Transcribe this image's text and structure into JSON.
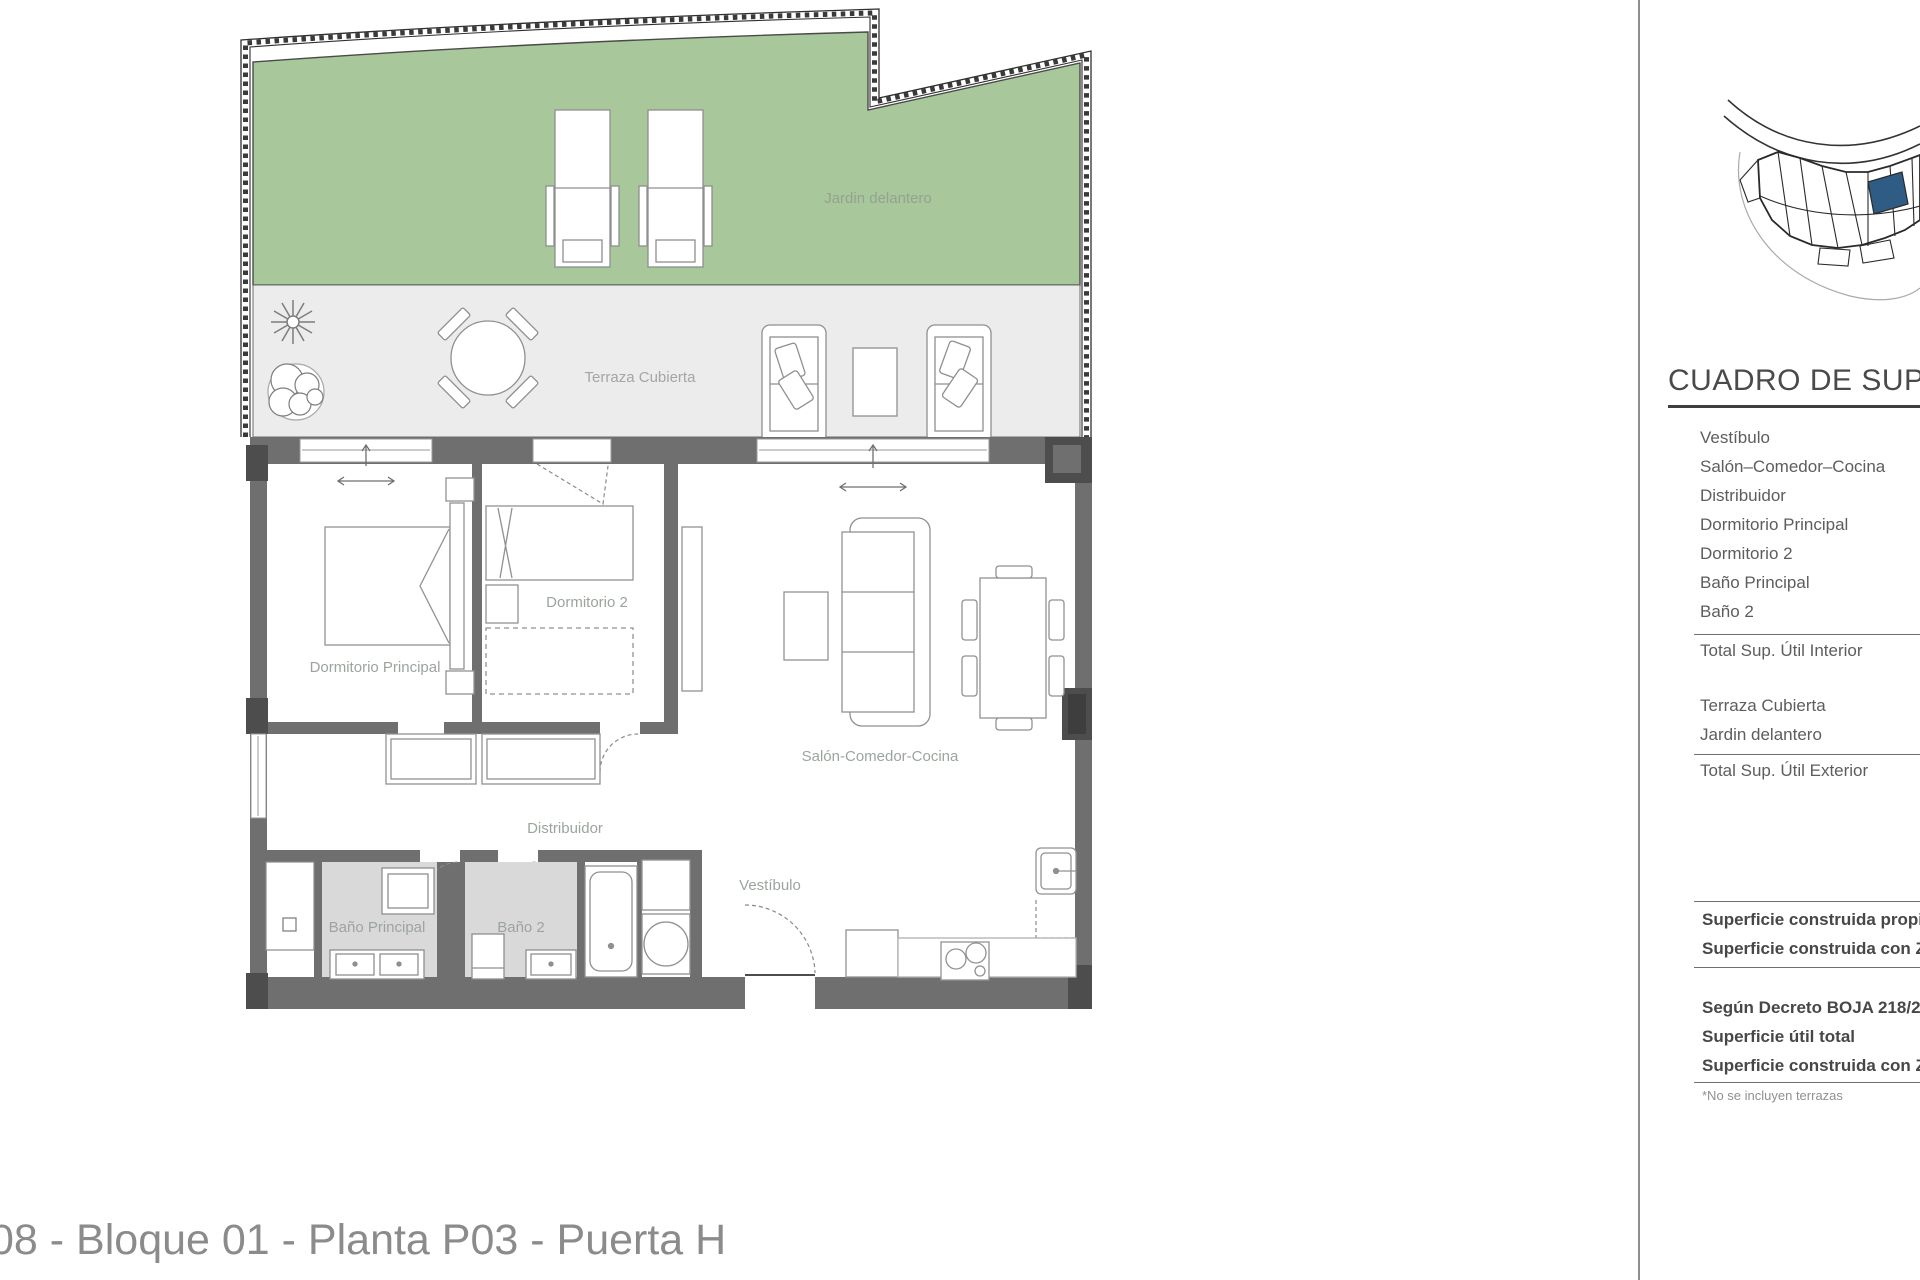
{
  "page": {
    "bottom_title": "08 - Bloque 01 - Planta P03 - Puerta H"
  },
  "plan": {
    "labels": {
      "garden": "Jardin delantero",
      "terrace": "Terraza Cubierta",
      "bedroom_main": "Dormitorio Principal",
      "bedroom_2": "Dormitorio 2",
      "living": "Salón-Comedor-Cocina",
      "hall": "Distribuidor",
      "vestibule": "Vestíbulo",
      "bath_main": "Baño Principal",
      "bath_2": "Baño 2"
    }
  },
  "panel": {
    "heading": "CUADRO DE SUPERF",
    "interior_rooms": [
      "Vestíbulo",
      "Salón–Comedor–Cocina",
      "Distribuidor",
      "Dormitorio Principal",
      "Dormitorio 2",
      "Baño Principal",
      "Baño 2"
    ],
    "interior_total": "Total Sup. Útil Interior",
    "exterior_rooms": [
      "Terraza Cubierta",
      "Jardin delantero"
    ],
    "exterior_total": "Total Sup. Útil Exterior",
    "built_rows": [
      "Superficie construida propia",
      "Superficie construida con ZZ"
    ],
    "decree_rows": [
      "Según Decreto BOJA 218/200",
      "Superficie útil total",
      "Superficie construida con ZZ"
    ],
    "footnote": "*No se incluyen terrazas"
  },
  "colors": {
    "garden_green": "#a8c79b",
    "terrace_gray": "#ececec",
    "bath_floor_gray": "#d9d9d9",
    "wall_gray": "#6f6f6f",
    "pillar_dark": "#4d4d4d",
    "unit_highlight_blue": "#2e5c84"
  }
}
